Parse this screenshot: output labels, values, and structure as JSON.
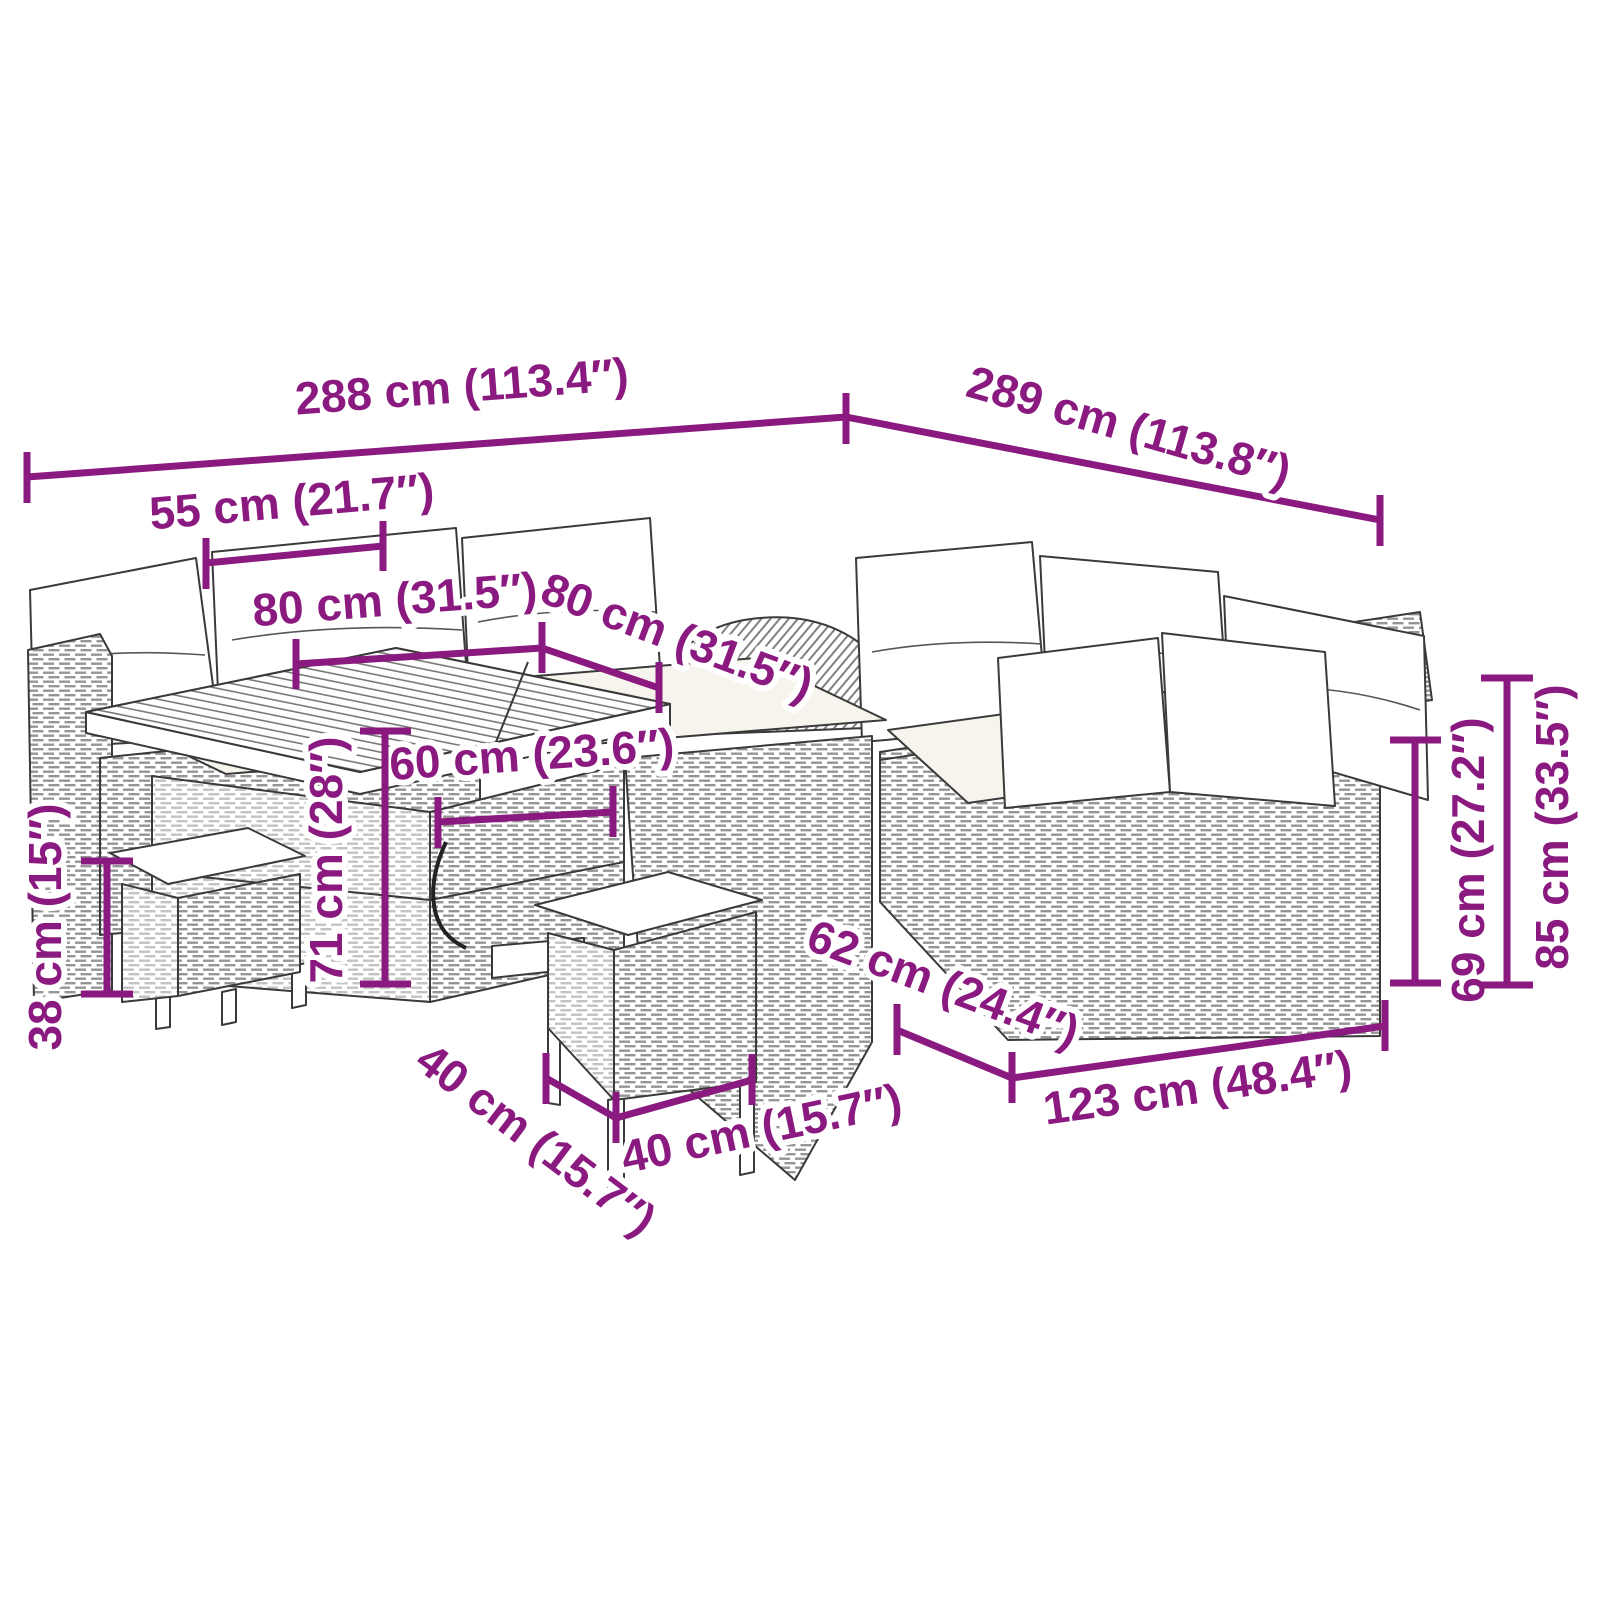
{
  "diagram": {
    "description": "Dimension diagram of a poly rattan garden lounge set: corner sofa with cushions, cube table and two stools",
    "accent_color": "#8B1A80",
    "line_art_color": "#3a3a3a",
    "background_color": "#ffffff",
    "labels": {
      "d288": "288 cm (113.4″)",
      "d289": "289 cm (113.8″)",
      "d55": "55 cm (21.7″)",
      "d80_left": "80 cm (31.5″)",
      "d80_right": "80 cm (31.5″)",
      "d60": "60 cm (23.6″)",
      "d71": "71 cm (28″)",
      "d38": "38 cm (15″)",
      "d40_left": "40 cm (15.7″)",
      "d40_right": "40 cm (15.7″)",
      "d62": "62 cm (24.4″)",
      "d123": "123 cm (48.4″)",
      "d69": "69 cm (27.2″)",
      "d85": "85 cm (33.5″)"
    }
  }
}
